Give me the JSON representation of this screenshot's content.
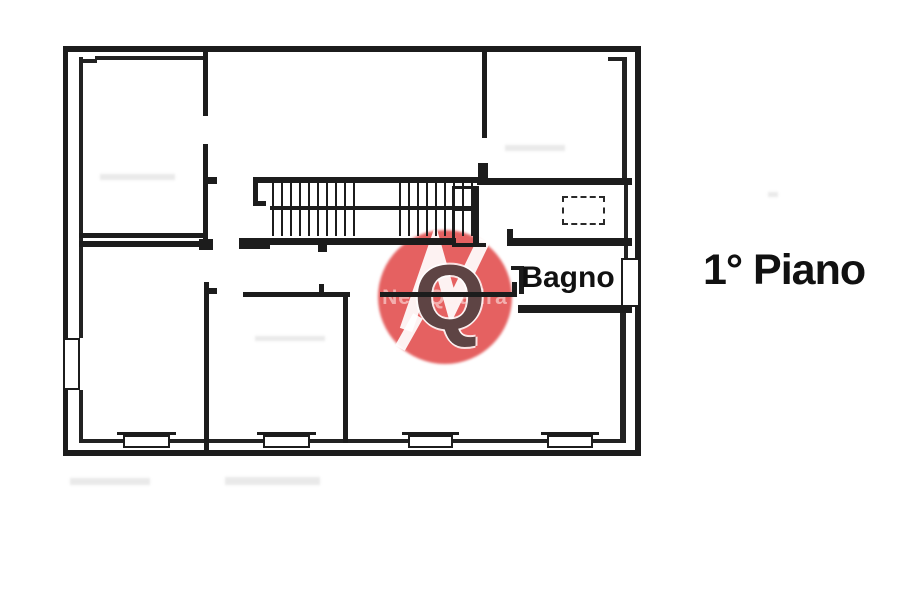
{
  "labels": {
    "bagno": "Bagno",
    "floor": "1° Piano"
  },
  "watermark": {
    "letter_q": "Q",
    "subtext": "NewQuadra",
    "circle_color": "#de3939",
    "zigzag_color": "#ffffff"
  },
  "colors": {
    "wall": "#1c1c1c",
    "background": "#ffffff",
    "label_text": "#111111"
  }
}
